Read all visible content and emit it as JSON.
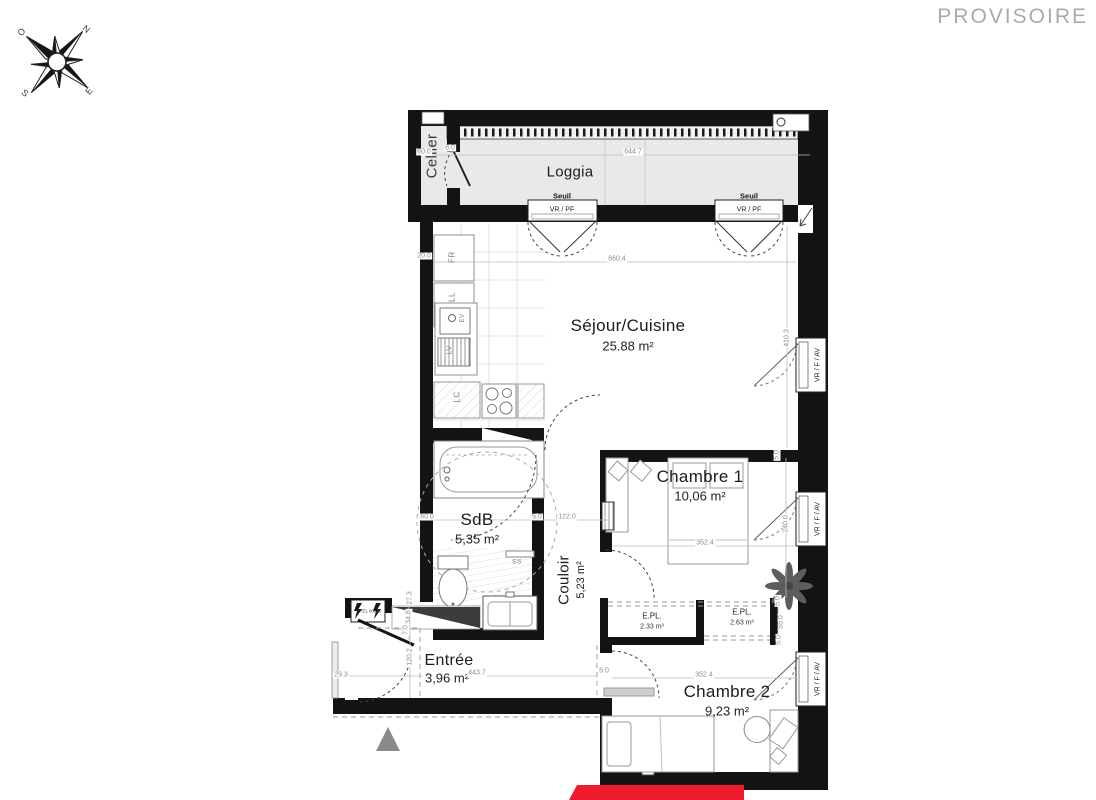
{
  "watermark": "PROVISOIRE",
  "compass": {
    "north": "N",
    "west": "O",
    "south": "S",
    "east": "E"
  },
  "rooms": {
    "loggia": {
      "name": "Loggia"
    },
    "cellier": {
      "name": "Cellier"
    },
    "sejour": {
      "name": "Séjour/Cuisine",
      "area": "25.88 m²"
    },
    "chambre1": {
      "name": "Chambre 1",
      "area": "10,06 m²"
    },
    "sdb": {
      "name": "SdB",
      "area": "5,35 m²"
    },
    "couloir": {
      "name": "Couloir",
      "area": "5,23 m²"
    },
    "entree": {
      "name": "Entrée",
      "area": "3,96 m²"
    },
    "chambre2": {
      "name": "Chambre 2",
      "area": "9,23 m²"
    },
    "placard1": {
      "name": "E.PL.",
      "volume": "2.33 m³"
    },
    "placard2": {
      "name": "E.PL.",
      "volume": "2.63 m³"
    }
  },
  "openings": {
    "seuil_label": "Seuil",
    "loggia_door_label": "VR / PF",
    "window_label": "VR / F / AV"
  },
  "equipment": {
    "fridge": "FR",
    "washer": "LL",
    "sink": "EV",
    "dishwasher": "LV",
    "counter": "LC",
    "towel_dryer": "SS",
    "electrical_panel": "ETEL 60x25"
  },
  "dimension_labels": [
    {
      "t": "644.7",
      "x": 633,
      "y": 152
    },
    {
      "t": "60.0",
      "x": 424,
      "y": 152
    },
    {
      "t": "6.0",
      "x": 450,
      "y": 148
    },
    {
      "t": "660.4",
      "x": 617,
      "y": 259
    },
    {
      "t": "410.3",
      "x": 787,
      "y": 338,
      "v": 1
    },
    {
      "t": "20.0",
      "x": 424,
      "y": 256
    },
    {
      "t": "5.0",
      "x": 777,
      "y": 455,
      "v": 1
    },
    {
      "t": "240.0",
      "x": 786,
      "y": 524,
      "v": 1
    },
    {
      "t": "352.4",
      "x": 705,
      "y": 543
    },
    {
      "t": "60.0",
      "x": 427,
      "y": 517
    },
    {
      "t": "5.0",
      "x": 537,
      "y": 517
    },
    {
      "t": "122.0",
      "x": 567,
      "y": 517
    },
    {
      "t": "5.0",
      "x": 778,
      "y": 601,
      "v": 1
    },
    {
      "t": "55.0",
      "x": 781,
      "y": 622,
      "v": 1
    },
    {
      "t": "5.0",
      "x": 779,
      "y": 640,
      "v": 1
    },
    {
      "t": "27.3",
      "x": 410,
      "y": 598,
      "v": 1
    },
    {
      "t": "34.8",
      "x": 409,
      "y": 617,
      "v": 1
    },
    {
      "t": "7.0",
      "x": 406,
      "y": 630,
      "v": 1
    },
    {
      "t": "120.2",
      "x": 410,
      "y": 657,
      "v": 1
    },
    {
      "t": "29.3",
      "x": 341,
      "y": 675
    },
    {
      "t": "443.7",
      "x": 477,
      "y": 673
    },
    {
      "t": "5.0",
      "x": 604,
      "y": 671
    },
    {
      "t": "352.4",
      "x": 704,
      "y": 675
    }
  ],
  "colors": {
    "wall": "#131313",
    "loggia_floor": "#e9e9e9",
    "accent_red": "#ee1c2e",
    "watermark_gray": "#a7abb0",
    "dimension_gray": "#8c8c8c"
  }
}
